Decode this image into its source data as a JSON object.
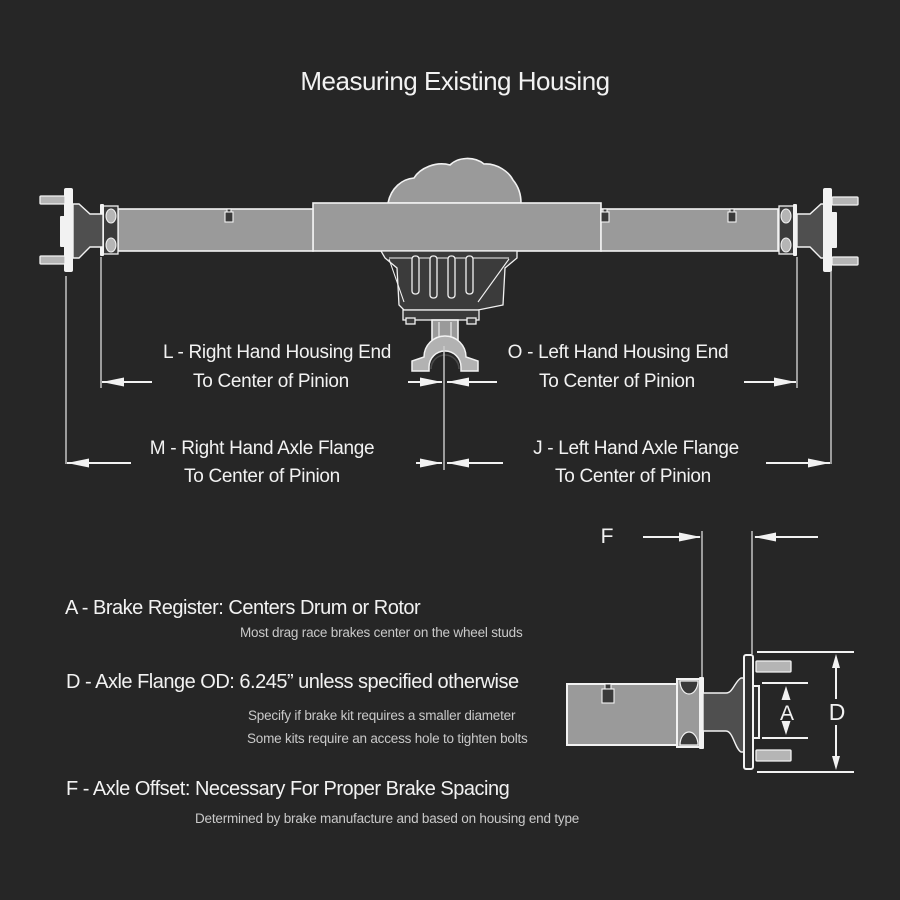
{
  "title": "Measuring Existing Housing",
  "colors": {
    "background": "#262626",
    "line_white": "#f2f2f2",
    "dim_line": "#cfcfcf",
    "tube_gray": "#9a9a9a",
    "shaft_gray": "#4f4f4f",
    "stud_gray": "#b5b5b5",
    "carrier_dark": "#3b3b3b",
    "yoke_gray": "#b2b2b2",
    "text_white": "#f2f2f2",
    "subtext_gray": "#c9c9c9"
  },
  "dimensions": {
    "L": {
      "line1": "L - Right Hand Housing End",
      "line2": "To Center of Pinion"
    },
    "O": {
      "line1": "O - Left Hand Housing End",
      "line2": "To Center of Pinion"
    },
    "M": {
      "line1": "M - Right Hand Axle Flange",
      "line2": "To Center of Pinion"
    },
    "J": {
      "line1": "J - Left Hand Axle Flange",
      "line2": "To Center of Pinion"
    },
    "F": {
      "letter": "F"
    },
    "A": {
      "letter": "A"
    },
    "D": {
      "letter": "D"
    }
  },
  "notes": [
    {
      "heading": "A - Brake Register: Centers Drum or Rotor",
      "details": [
        "Most drag race brakes center on the wheel studs"
      ]
    },
    {
      "heading": "D - Axle Flange OD: 6.245” unless specified otherwise",
      "details": [
        "Specify if brake kit requires a smaller diameter",
        "Some kits require an access hole to tighten bolts"
      ]
    },
    {
      "heading": "F - Axle Offset: Necessary For Proper Brake Spacing",
      "details": [
        "Determined by brake manufacture and based on housing end type"
      ]
    }
  ]
}
